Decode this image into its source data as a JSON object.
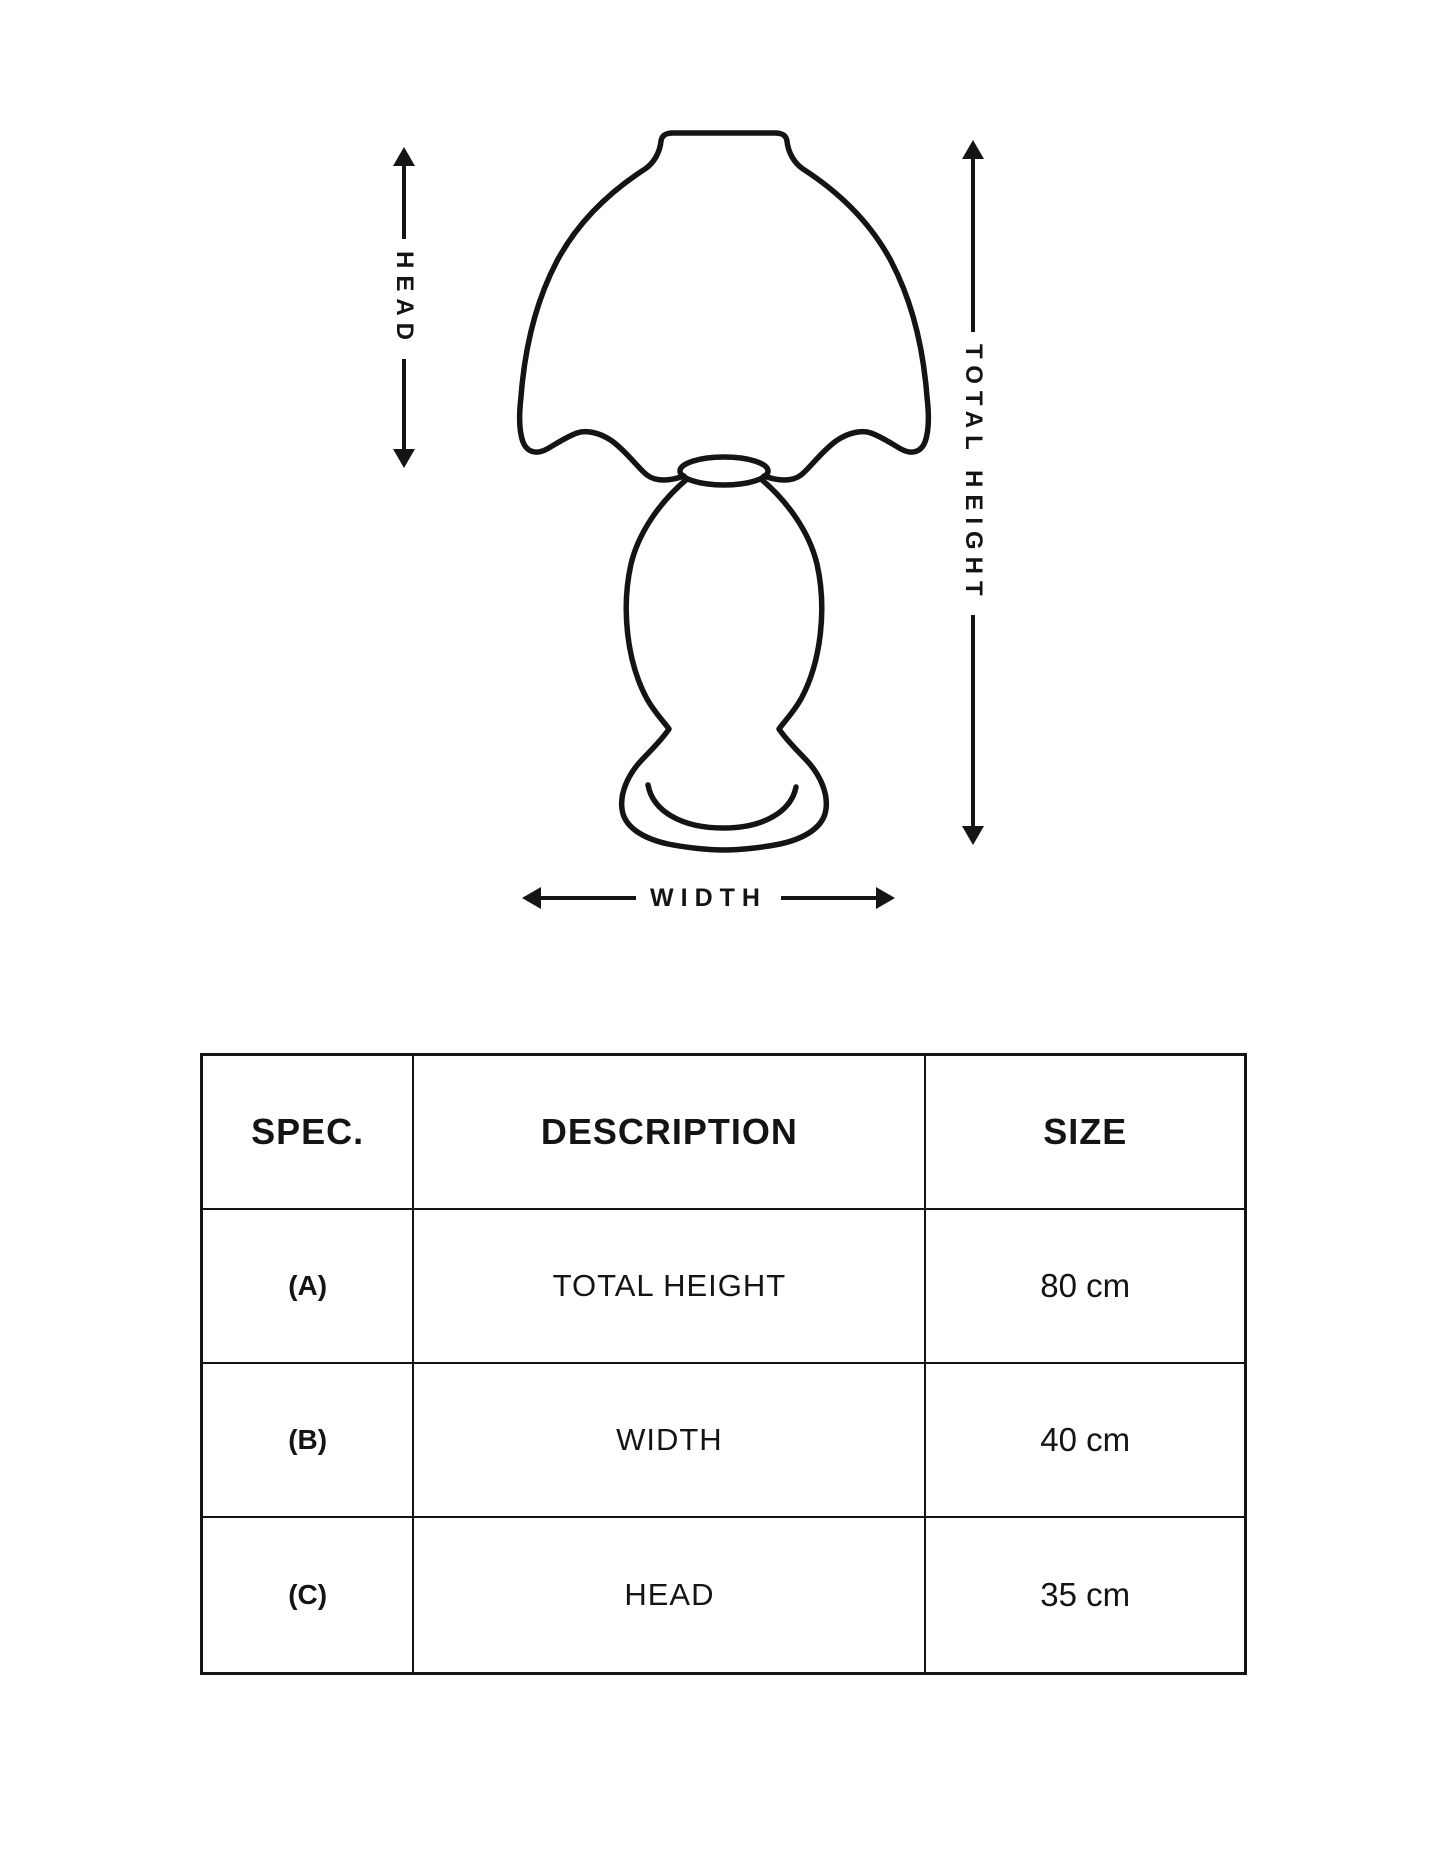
{
  "page": {
    "background": "#ffffff",
    "ink": "#141414"
  },
  "diagram": {
    "subject": "table-lamp-outline-drawing",
    "head_label": "HEAD",
    "total_height_label": "TOTAL HEIGHT",
    "width_label": "WIDTH"
  },
  "icons": {
    "arrow_up": "filled-triangle-up",
    "arrow_down": "filled-triangle-down",
    "arrow_left": "filled-triangle-left",
    "arrow_right": "filled-triangle-right"
  },
  "spec_table": {
    "headers": {
      "spec": "SPEC.",
      "description": "DESCRIPTION",
      "size": "SIZE"
    },
    "rows": [
      {
        "spec": "(A)",
        "description": "TOTAL HEIGHT",
        "size": "80 cm"
      },
      {
        "spec": "(B)",
        "description": "WIDTH",
        "size": "40 cm"
      },
      {
        "spec": "(C)",
        "description": "HEAD",
        "size": "35 cm"
      }
    ]
  }
}
